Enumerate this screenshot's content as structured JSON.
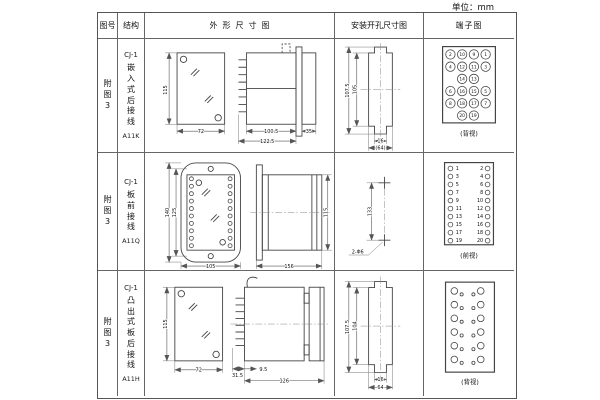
{
  "unit_label": "单位：mm",
  "colors": {
    "line": "#444444",
    "border": "#666666",
    "text": "#111111",
    "bg": "#ffffff"
  },
  "table": {
    "headers": {
      "fig_no": "图号",
      "structure": "结构",
      "outline": "外形尺寸图",
      "mounting": "安装开孔尺寸图",
      "terminal": "端子图"
    },
    "rows": [
      {
        "fig_no": "附图3",
        "structure": {
          "model": "CJ-1",
          "mount": "嵌入式后接线",
          "code": "A11K"
        },
        "outline": {
          "front_h": "115",
          "front_w": "72",
          "d1": "100.5",
          "d2": "122.5",
          "d3": "35"
        },
        "mounting": {
          "h1": "107.5",
          "h2": "105",
          "w1": "16",
          "w2": "(64)"
        },
        "terminal": {
          "view": "(背视)",
          "grid": [
            [
              "2",
              "10",
              "9",
              "1"
            ],
            [
              "4",
              "12",
              "11",
              "3"
            ],
            [
              "14",
              "13"
            ],
            [
              "6",
              "16",
              "15",
              "5"
            ],
            [
              "8",
              "18",
              "17",
              "7"
            ],
            [
              "20",
              "19"
            ]
          ]
        }
      },
      {
        "fig_no": "附图3",
        "structure": {
          "model": "CJ-1",
          "mount": "板前接线",
          "code": "A11Q"
        },
        "outline": {
          "front_h1": "140",
          "front_h2": "125",
          "front_w": "105",
          "side_l": "156",
          "side_h": "115"
        },
        "mounting": {
          "spacing": "133",
          "holes": "2-Φ6"
        },
        "terminal": {
          "view": "(前视)",
          "left": [
            "1",
            "3",
            "5",
            "7",
            "9",
            "11",
            "13",
            "15",
            "17",
            "19"
          ],
          "right": [
            "2",
            "4",
            "6",
            "8",
            "10",
            "12",
            "14",
            "16",
            "18",
            "20"
          ]
        }
      },
      {
        "fig_no": "附图3",
        "structure": {
          "model": "CJ-1",
          "mount": "凸出式板后接线",
          "code": "A11H"
        },
        "outline": {
          "front_h": "115",
          "front_w": "72",
          "d1": "31.5",
          "d2": "9.5",
          "d3": "126"
        },
        "mounting": {
          "h1": "107.5",
          "h2": "104",
          "w1": "16",
          "w2": "64"
        },
        "terminal": {
          "view": "(背视)"
        }
      }
    ]
  }
}
